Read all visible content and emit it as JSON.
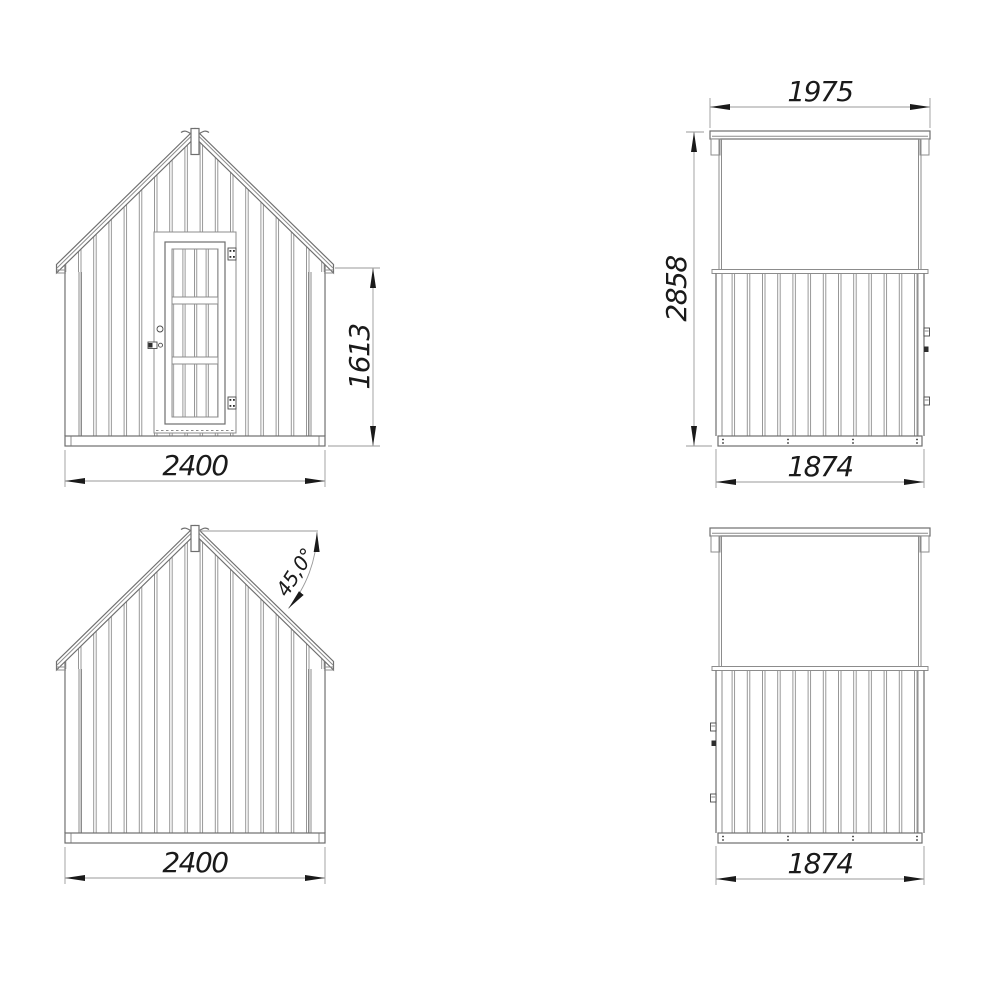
{
  "drawing": {
    "type": "shed four-view technical drawing",
    "colors": {
      "background": "#ffffff",
      "building_line": "#8c8c8c",
      "building_outline": "#6f6f6f",
      "dimension_line": "#9a9a9a",
      "dimension_text": "#1a1a1a"
    },
    "views": {
      "front_elevation": {
        "width_mm": "2400",
        "wall_height_mm": "1613"
      },
      "rear_elevation": {
        "width_mm": "2400",
        "roof_angle": "45,0°"
      },
      "side_elevation_right": {
        "roof_length_mm": "1975",
        "total_height_mm": "2858",
        "wall_length_mm": "1874"
      },
      "side_elevation_left": {
        "wall_length_mm": "1874"
      }
    }
  }
}
